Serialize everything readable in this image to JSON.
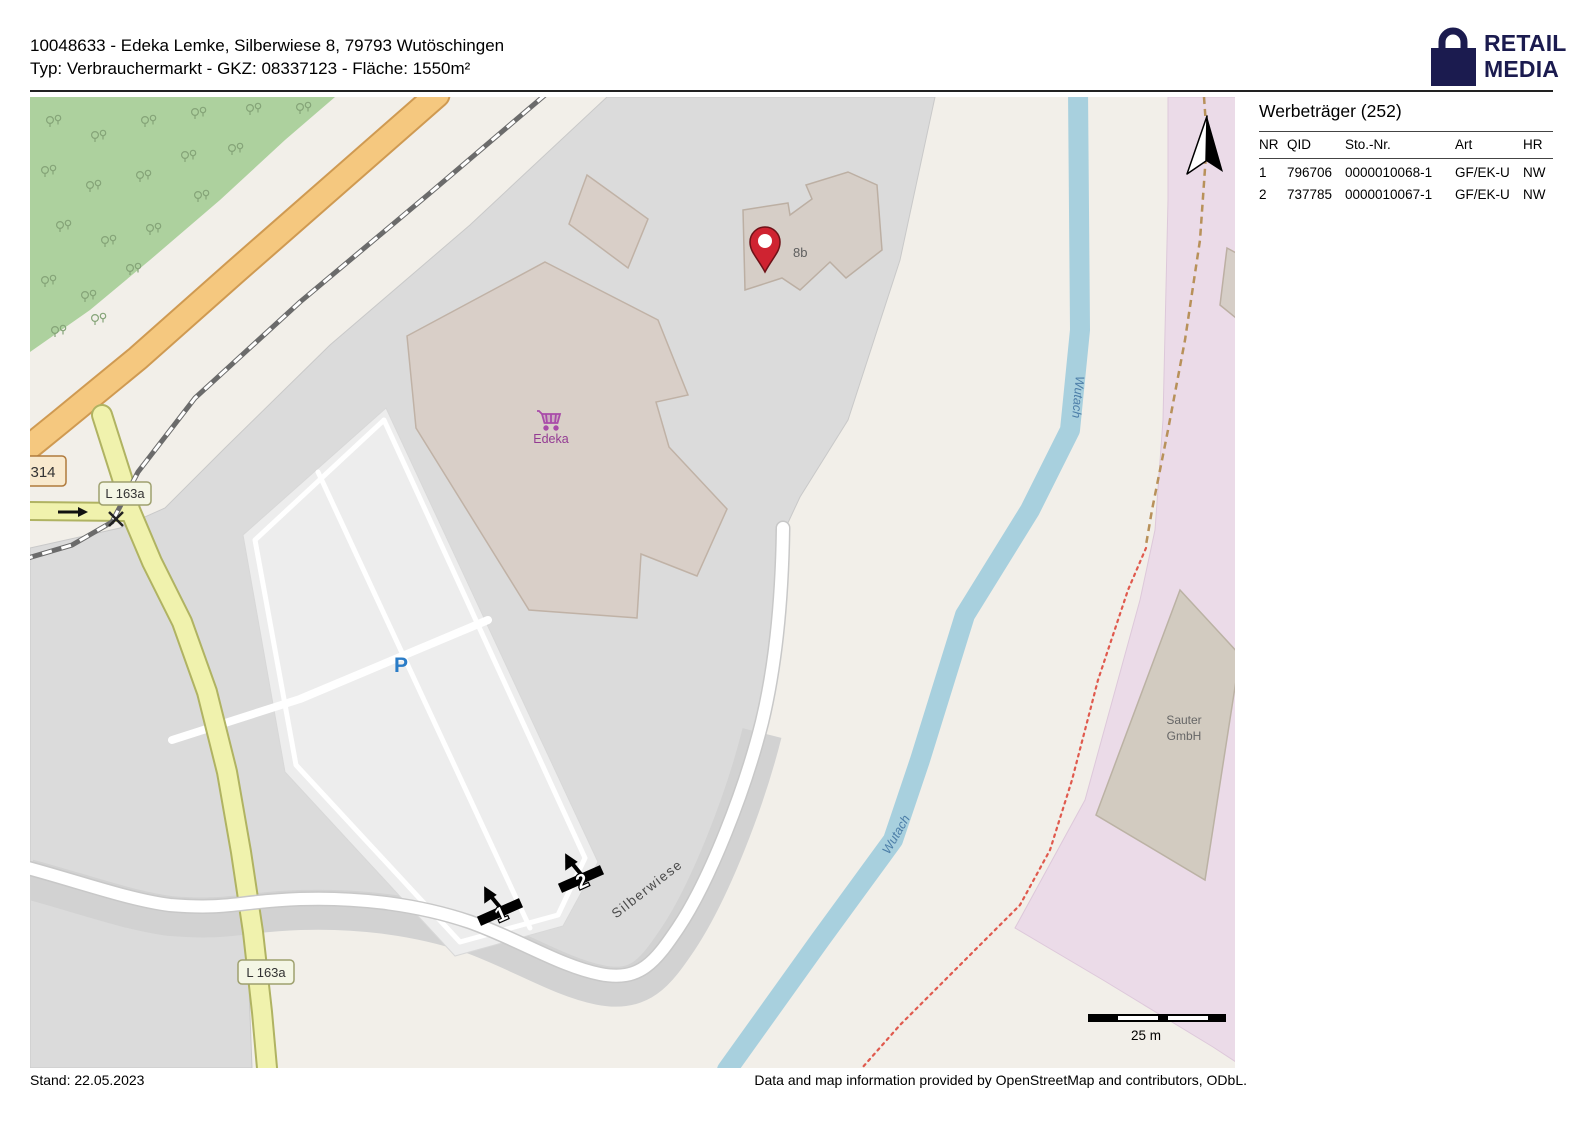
{
  "header": {
    "line1": "10048633 - Edeka Lemke, Silberwiese 8, 79793 Wutöschingen",
    "line2": "Typ: Verbrauchermarkt - GKZ: 08337123 - Fläche: 1550m²"
  },
  "logo": {
    "line1": "RETAIL",
    "line2": "MEDIA",
    "color": "#1b1b4f"
  },
  "sidebar": {
    "title": "Werbeträger (252)",
    "columns": [
      "NR",
      "QID",
      "Sto.-Nr.",
      "Art",
      "HR"
    ],
    "rows": [
      [
        "1",
        "796706",
        "0000010068-1",
        "GF/EK-U",
        "NW"
      ],
      [
        "2",
        "737785",
        "0000010067-1",
        "GF/EK-U",
        "NW"
      ]
    ]
  },
  "footer": {
    "stand": "Stand: 22.05.2023",
    "attribution": "Data and map information provided by OpenStreetMap and contributors, ODbL."
  },
  "map": {
    "edeka_label": "Edeka",
    "house_number": "8b",
    "sauter_line1": "Sauter",
    "sauter_line2": "GmbH",
    "street_label": "Silberwiese",
    "river_label_1": "Wutach",
    "river_label_2": "Wutach",
    "badge_l163a_1": "L 163a",
    "badge_l163a_2": "L 163a",
    "badge_314": "314",
    "parking_label": "P",
    "scale_label": "25 m",
    "marker_1": "1",
    "marker_2": "2",
    "colors": {
      "background": "#f2efe9",
      "forest": "#add19e",
      "urban_gray": "#dbdbdb",
      "parking_lot": "#ededed",
      "industrial_pink": "#ebdbe8",
      "building": "#d9cfc8",
      "river": "#a8d0de",
      "road_primary": "#f5c87f",
      "road_secondary": "#f0f2ad",
      "pin_red": "#cf2331",
      "edeka_purple": "#a94ca9",
      "parking_blue": "#2a7cc7"
    }
  }
}
